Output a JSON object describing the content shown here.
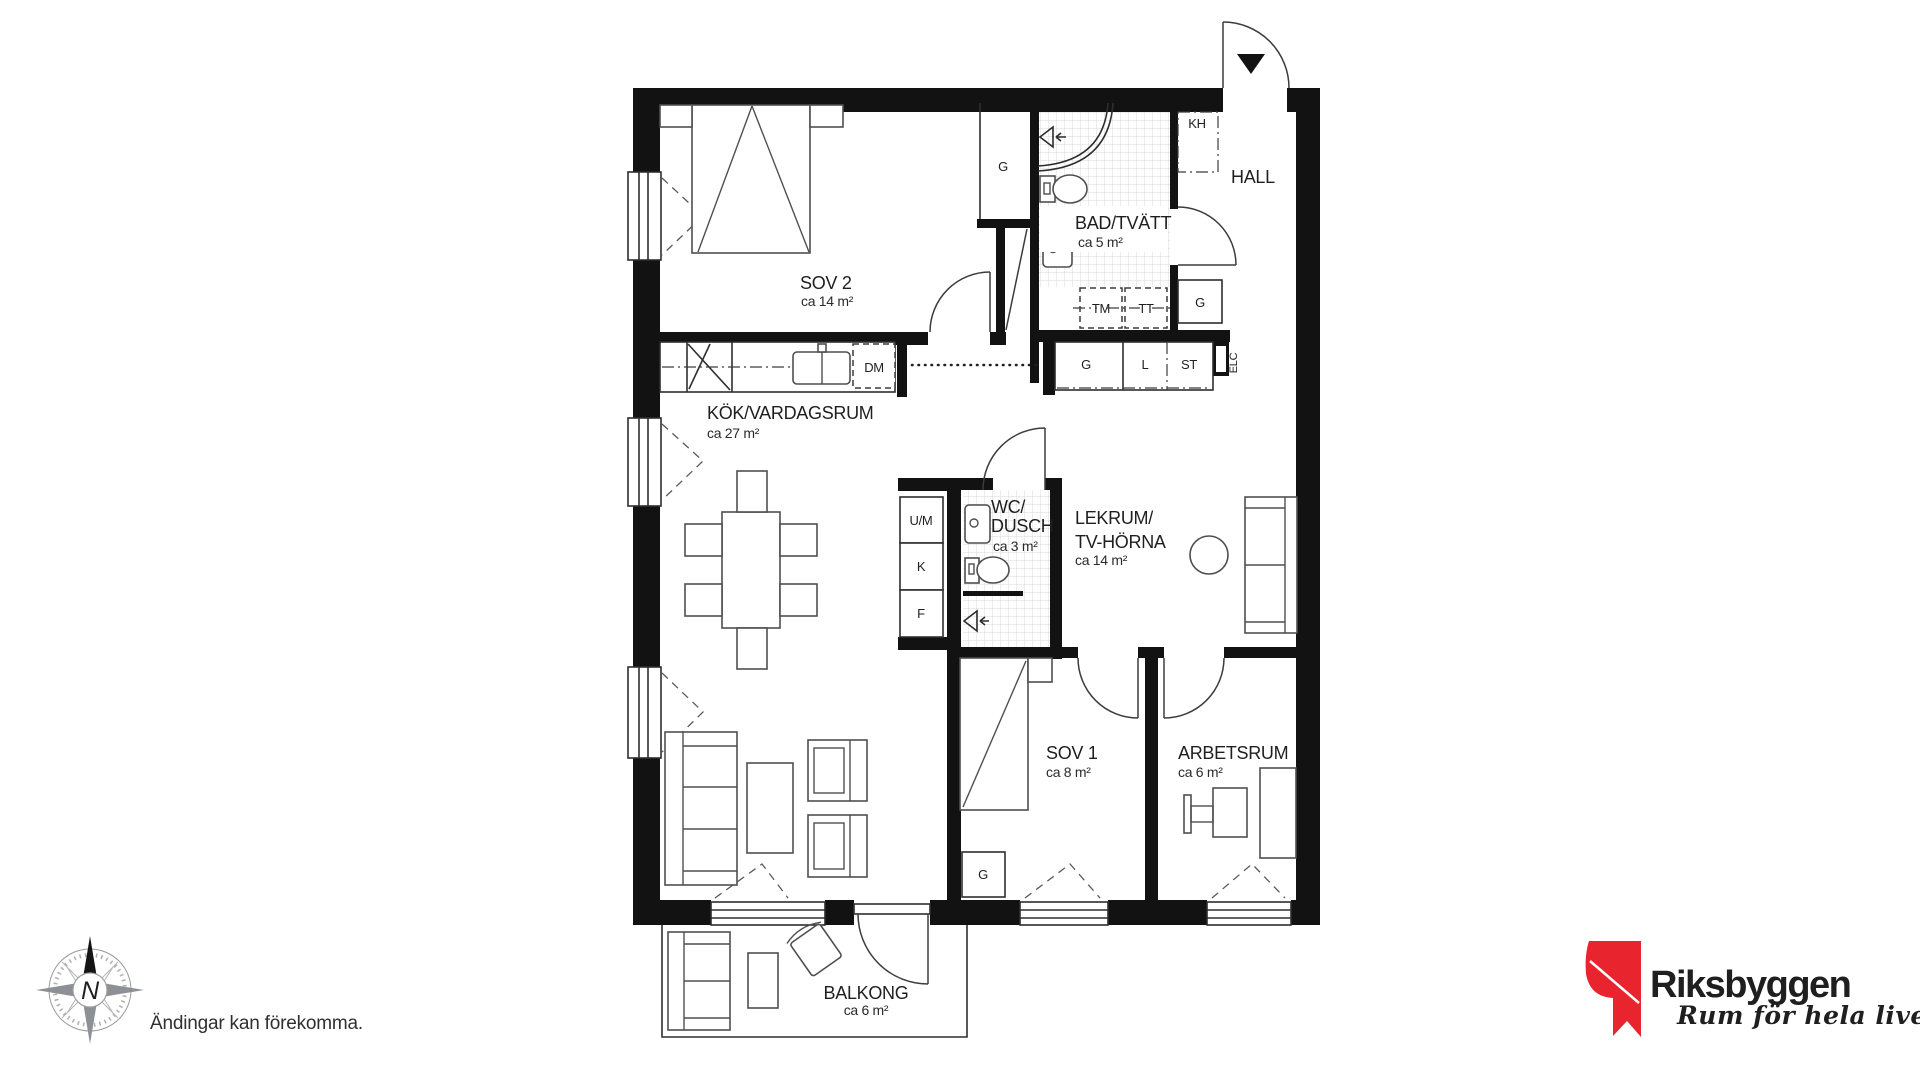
{
  "plan": {
    "rooms": {
      "sov2": {
        "label": "SOV 2",
        "area": "ca 14 m²"
      },
      "bad_tvatt": {
        "label": "BAD/TVÄTT",
        "area": "ca 5 m²"
      },
      "hall": {
        "label": "HALL"
      },
      "kok_vardagsrum": {
        "label": "KÖK/VARDAGSRUM",
        "area": "ca 27 m²"
      },
      "wc_dusch": {
        "label_line1": "WC/",
        "label_line2": "DUSCH",
        "area": "ca 3 m²"
      },
      "lekrum": {
        "label_line1": "LEKRUM/",
        "label_line2": "TV-HÖRNA",
        "area": "ca 14 m²"
      },
      "sov1": {
        "label": "SOV 1",
        "area": "ca 8 m²"
      },
      "arbetsrum": {
        "label": "ARBETSRUM",
        "area": "ca 6 m²"
      },
      "balkong": {
        "label": "BALKONG",
        "area": "ca 6 m²"
      }
    },
    "fixtures": {
      "wardrobe": "G",
      "kh": "KH",
      "tm": "TM",
      "tt": "TT",
      "linen": "L",
      "st": "ST",
      "elc": "ELC",
      "dm": "DM",
      "um": "U/M",
      "fridge": "K",
      "freezer": "F"
    },
    "compass": {
      "north": "N"
    }
  },
  "footer": {
    "disclaimer": "Ändingar kan förekomma."
  },
  "logo": {
    "brand": "Riksbyggen",
    "tagline": "Rum för hela livet",
    "colors": {
      "red": "#e8242e",
      "gray": "#9c9c9b",
      "black": "#0a0a0a"
    }
  }
}
